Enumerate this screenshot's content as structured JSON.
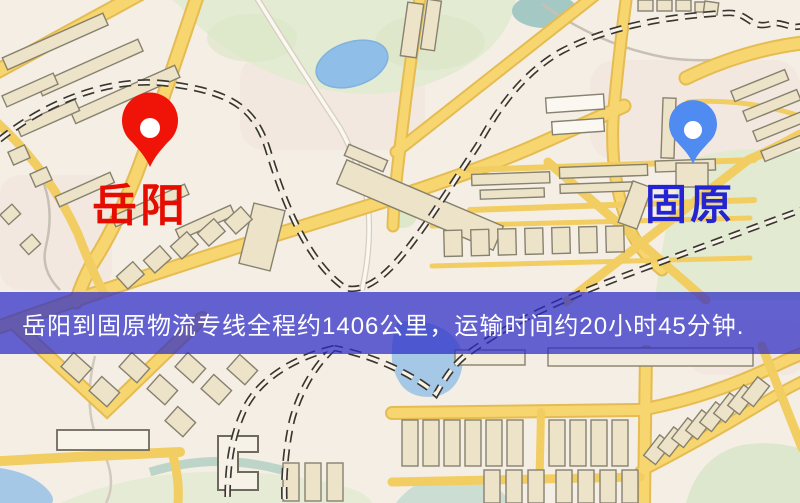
{
  "map": {
    "origin": {
      "label": "岳阳",
      "pin_color": "#f01408",
      "label_color": "#e60d00"
    },
    "destination": {
      "label": "固原",
      "pin_color": "#4f8bf0",
      "label_color": "#2424d2"
    },
    "palette": {
      "background": "#f5eee4",
      "road_yellow": "#f7d56f",
      "road_casing": "#e5bc52",
      "park_green": "#e4ebd3",
      "water_blue": "#a5c8e6",
      "lake_blue": "#8fbfe8",
      "building_tan": "#ece3c8",
      "railway_dark": "#3a352e"
    }
  },
  "banner": {
    "text": "岳阳到固原物流专线全程约1406公里，运输时间约20小时45分钟.",
    "background_color": "rgba(43,43,198,0.72)",
    "text_color": "#ffffff"
  }
}
